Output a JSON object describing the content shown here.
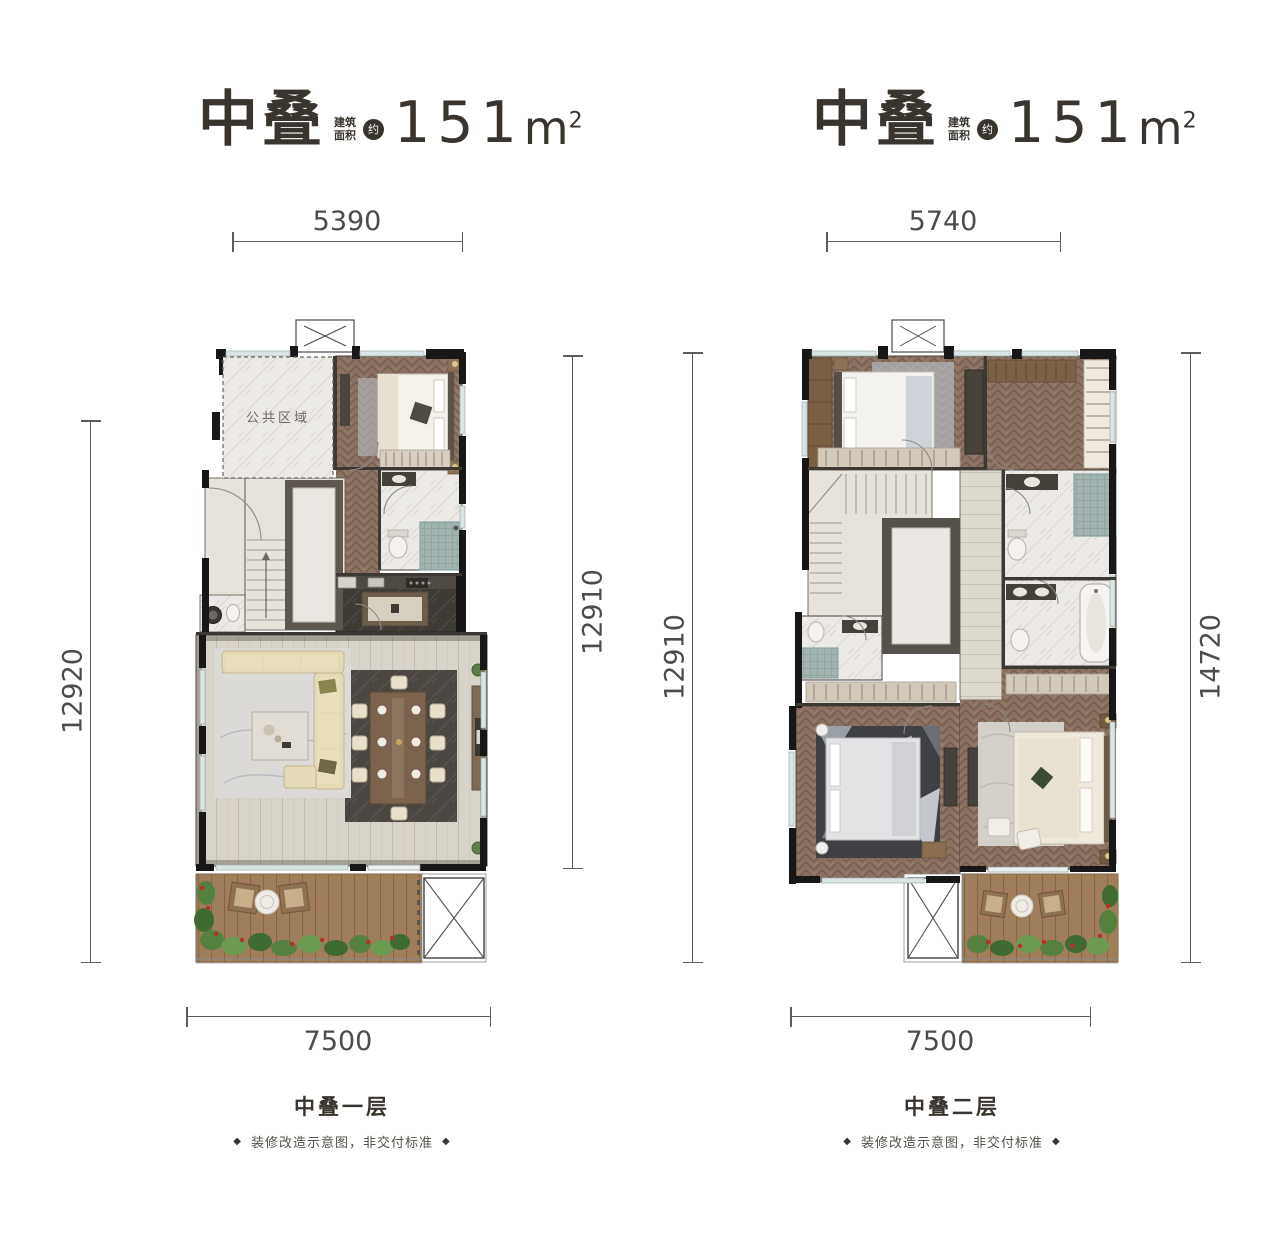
{
  "plans": [
    {
      "title": "中叠",
      "area_label": "建筑面积",
      "area_approx": "约",
      "area_value": "151",
      "area_unit": "m",
      "area_unit_sup": "2",
      "dim_top": "5390",
      "dim_left": "12920",
      "dim_right": "12910",
      "dim_bottom": "7500",
      "caption": "中叠一层",
      "disclaimer": "装修改造示意图，非交付标准",
      "deco": "◆",
      "room_label": "公共区域"
    },
    {
      "title": "中叠",
      "area_label": "建筑面积",
      "area_approx": "约",
      "area_value": "151",
      "area_unit": "m",
      "area_unit_sup": "2",
      "dim_top": "5740",
      "dim_left": "12910",
      "dim_right": "14720",
      "dim_bottom": "7500",
      "caption": "中叠二层",
      "disclaimer": "装修改造示意图，非交付标准",
      "deco": "◆"
    }
  ]
}
